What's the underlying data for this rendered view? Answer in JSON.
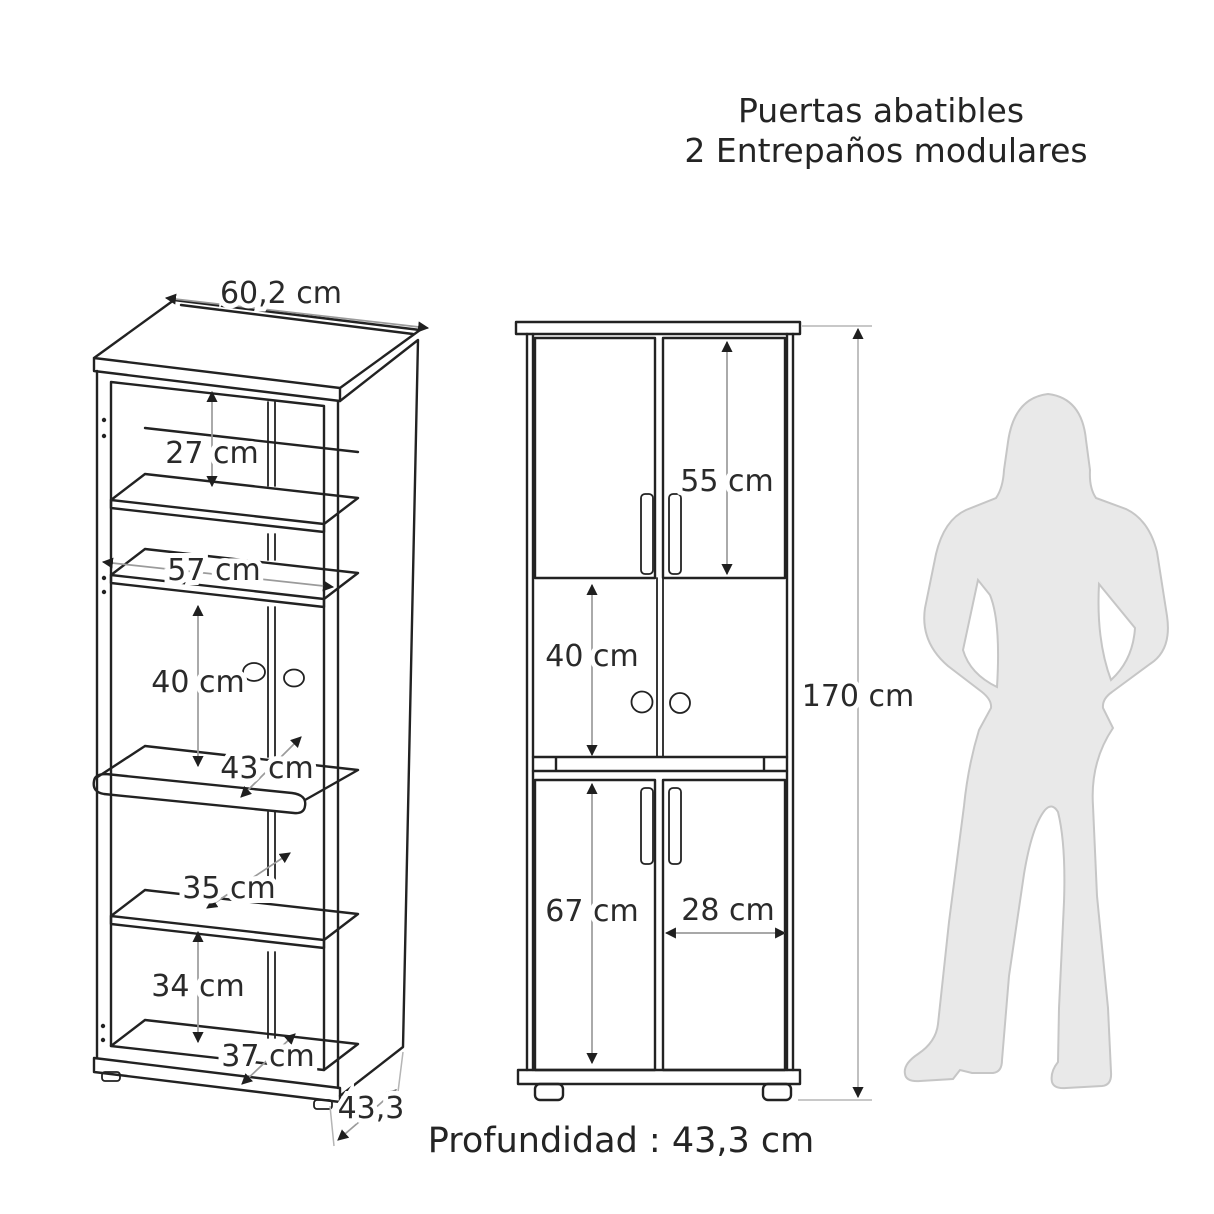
{
  "title": {
    "line1": "Puertas abatibles",
    "line2": "2 Entrepaños modulares"
  },
  "left_view": {
    "labels": {
      "width_top": "60,2 cm",
      "section_top_height": "27 cm",
      "interior_width": "57 cm",
      "section_middle_height": "40 cm",
      "shelf_pullout_depth": "43 cm",
      "shelf_lower_depth": "35 cm",
      "section_bottom_height": "34 cm",
      "base_depth": "37 cm",
      "depth_side": "43,3"
    }
  },
  "right_view": {
    "labels": {
      "upper_door_height": "55 cm",
      "middle_open_height": "40 cm",
      "total_height": "170 cm",
      "lower_door_height": "67 cm",
      "door_width": "28 cm"
    }
  },
  "footer": {
    "depth_note": "Profundidad : 43,3 cm"
  },
  "colors": {
    "line": "#222222",
    "dimension_line": "#9b9b9b",
    "dimension_line_light": "#b5b5b5",
    "silhouette_fill": "#e9e9e9",
    "silhouette_stroke": "#c6c6c6",
    "text": "#2a2a2a",
    "background": "#ffffff"
  }
}
